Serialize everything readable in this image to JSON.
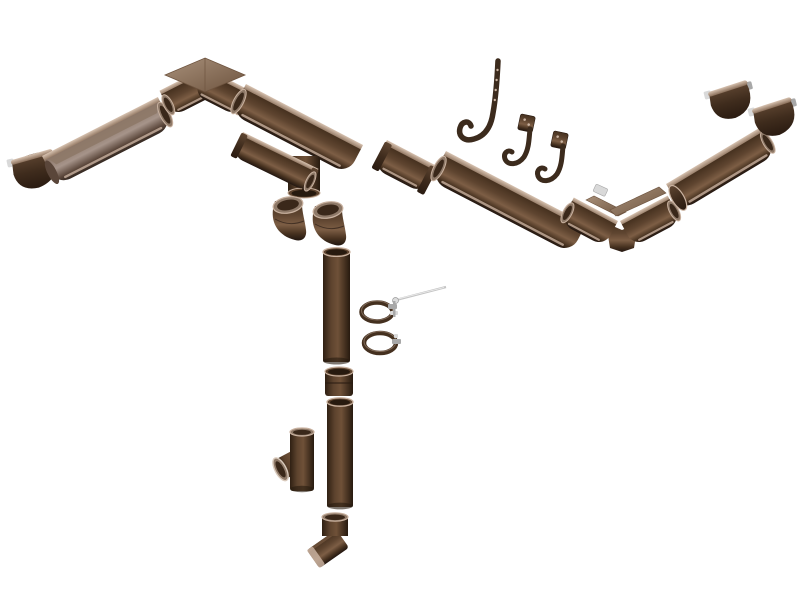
{
  "image": {
    "type": "product-photo",
    "subject": "Exploded isometric view of a brown half-round rain gutter and downspout system on a white background",
    "visible_text": ""
  },
  "palette": {
    "background": "#ffffff",
    "gutter_dark": "#46311f",
    "gutter_mid": "#5f4530",
    "gutter_light": "#7d5e45",
    "gutter_deep": "#221610",
    "rim_light": "#d8c3b1",
    "rim_dark": "#8a6f5a",
    "taupe_mid": "#8b7668",
    "taupe_light": "#a6948a",
    "taupe_dark": "#5a463a",
    "taupe_deep": "#342821",
    "pipe_dark": "#2f2013",
    "pipe_mid": "#5d432e",
    "pipe_light": "#6f5138",
    "pipe_deep": "#271a0f",
    "cap_light": "#5e4531",
    "cap_mid": "#3f2c1d",
    "cap_deep": "#2a1b11",
    "roof_light": "#a8907a",
    "roof_dark": "#6e543f",
    "interior": "#8e7968",
    "interior_dark": "#3a281a",
    "mouth_rim": "#c9b2a0",
    "metal_light": "#d9d9d9",
    "metal_mid": "#a8a8a8",
    "hook_brown": "#3c2b1d",
    "clamp_brown": "#44301f",
    "screw_gray": "#c4c4c4",
    "screw_head": "#dcdcdc"
  },
  "components": [
    {
      "id": "gutter-end-cap-left",
      "label": "Gutter end cap (left)"
    },
    {
      "id": "gutter-section-left",
      "label": "Half-round gutter section, left run"
    },
    {
      "id": "gutter-inside-corner",
      "label": "Gutter inside corner 90 degrees"
    },
    {
      "id": "gutter-section-main-1",
      "label": "Half-round gutter section"
    },
    {
      "id": "gutter-outlet-funnel",
      "label": "Gutter outlet funnel for downspout"
    },
    {
      "id": "downspout-elbow-1",
      "label": "Downspout elbow"
    },
    {
      "id": "downspout-elbow-2",
      "label": "Downspout elbow"
    },
    {
      "id": "gutter-union-connector",
      "label": "Gutter union connector"
    },
    {
      "id": "gutter-section-main-2",
      "label": "Half-round gutter section"
    },
    {
      "id": "rafter-hook-long",
      "label": "Long rafter gutter hook with screw holes"
    },
    {
      "id": "gutter-bracket-1",
      "label": "Gutter fascia bracket"
    },
    {
      "id": "gutter-bracket-2",
      "label": "Gutter fascia bracket"
    },
    {
      "id": "gutter-outside-corner",
      "label": "Gutter outside corner 90 degrees"
    },
    {
      "id": "gutter-section-right",
      "label": "Half-round gutter section, right run"
    },
    {
      "id": "gutter-end-cap-right-1",
      "label": "Gutter end cap (right)"
    },
    {
      "id": "gutter-end-cap-right-2",
      "label": "Gutter end cap (right)"
    },
    {
      "id": "downspout-pipe-upper",
      "label": "Downspout pipe, upper"
    },
    {
      "id": "downspout-coupling",
      "label": "Downspout coupling sleeve"
    },
    {
      "id": "downspout-pipe-lower",
      "label": "Downspout pipe, lower"
    },
    {
      "id": "downspout-tee-branch",
      "label": "Downspout branch tee"
    },
    {
      "id": "downspout-shoe",
      "label": "Downspout outlet shoe"
    },
    {
      "id": "mounting-screw",
      "label": "Mounting screw for pipe clamp"
    },
    {
      "id": "pipe-clamp-1",
      "label": "Downspout pipe clamp"
    },
    {
      "id": "pipe-clamp-2",
      "label": "Downspout pipe clamp"
    }
  ]
}
